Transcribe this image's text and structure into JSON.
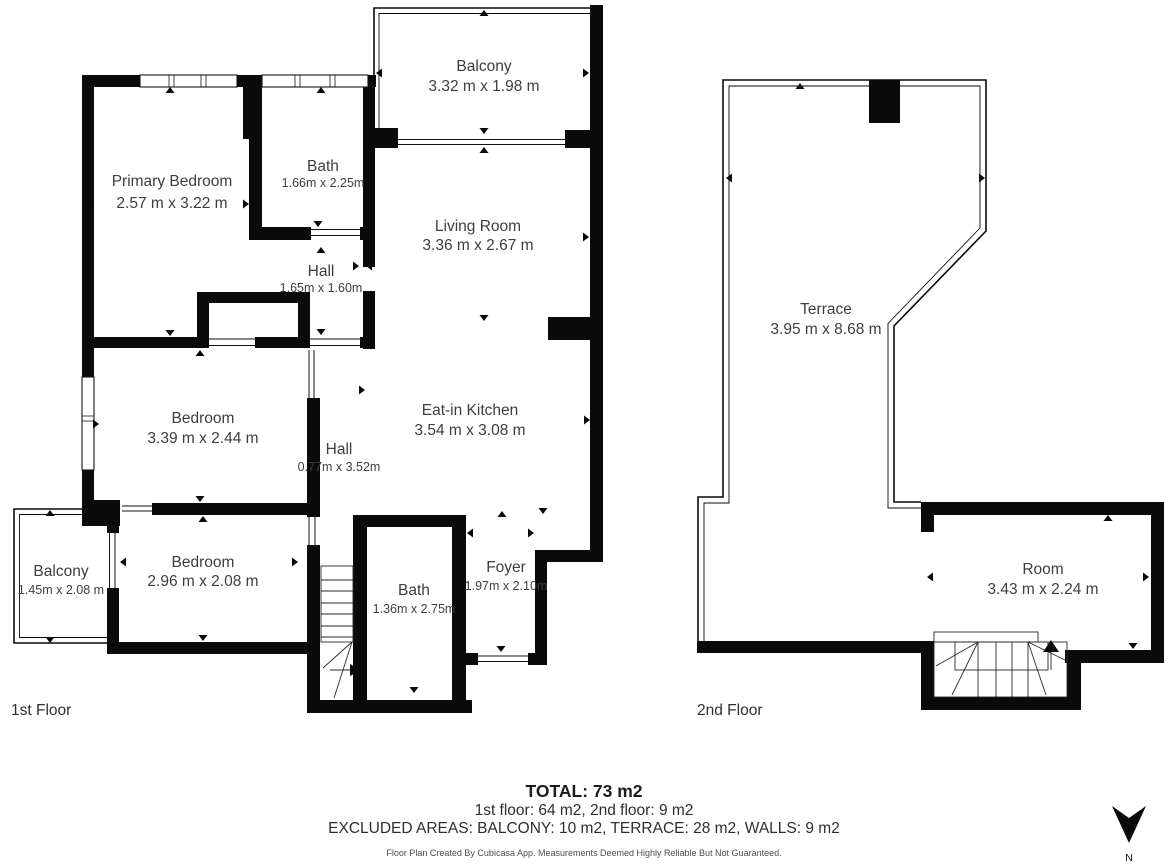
{
  "colors": {
    "wall": "#0a0a0a",
    "text": "#3e3e3e"
  },
  "floor1": {
    "label": "1st Floor",
    "rooms": {
      "primary_bedroom": {
        "name": "Primary Bedroom",
        "dims": "2.57 m x 3.22 m"
      },
      "bath_top": {
        "name": "Bath",
        "dims": "1.66m x 2.25m"
      },
      "hall_top": {
        "name": "Hall",
        "dims": "1.65m x 1.60m"
      },
      "balcony_top": {
        "name": "Balcony",
        "dims": "3.32 m x 1.98 m"
      },
      "living_room": {
        "name": "Living Room",
        "dims": "3.36 m x 2.67 m"
      },
      "bedroom_mid": {
        "name": "Bedroom",
        "dims": "3.39 m x 2.44 m"
      },
      "hall_mid": {
        "name": "Hall",
        "dims": "0.77m x 3.52m"
      },
      "kitchen": {
        "name": "Eat-in Kitchen",
        "dims": "3.54 m x 3.08 m"
      },
      "balcony_left": {
        "name": "Balcony",
        "dims": "1.45m x 2.08 m"
      },
      "bedroom_bottom": {
        "name": "Bedroom",
        "dims": "2.96 m x 2.08 m"
      },
      "bath_bottom": {
        "name": "Bath",
        "dims": "1.36m x 2.75m"
      },
      "foyer": {
        "name": "Foyer",
        "dims": "1.97m x 2.10m"
      }
    }
  },
  "floor2": {
    "label": "2nd Floor",
    "rooms": {
      "terrace": {
        "name": "Terrace",
        "dims": "3.95 m x 8.68 m"
      },
      "room": {
        "name": "Room",
        "dims": "3.43 m x 2.24 m"
      }
    }
  },
  "summary": {
    "total": "TOTAL: 73 m2",
    "floors": "1st floor: 64 m2, 2nd floor: 9 m2",
    "excluded": "EXCLUDED AREAS: BALCONY: 10 m2, TERRACE: 28 m2, WALLS: 9 m2",
    "disclaimer": "Floor Plan Created By Cubicasa App. Measurements Deemed Highly Reliable But Not Guaranteed."
  },
  "compass": {
    "label": "N"
  }
}
